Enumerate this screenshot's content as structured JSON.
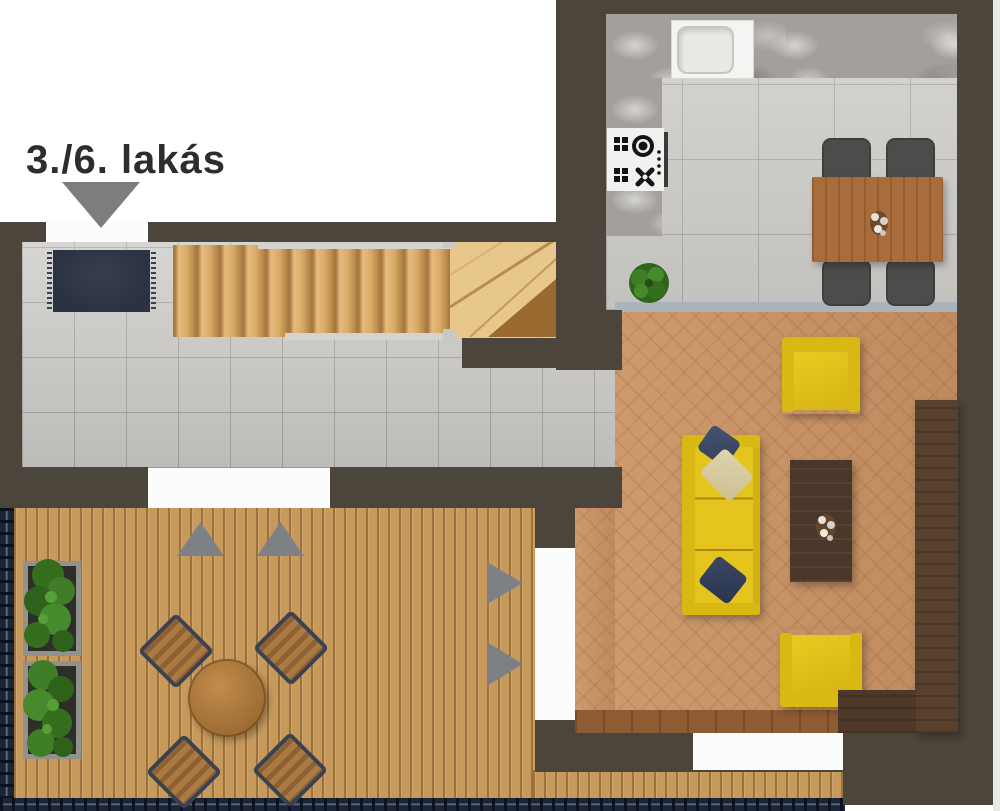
{
  "window": {
    "width": 1000,
    "height": 811
  },
  "plan": {
    "label": "3./6. lakás",
    "kind": "apartment floor plan, top-down render",
    "rooms": [
      {
        "id": "kitchen-dining",
        "furniture": [
          "L-shaped marble counter",
          "sink",
          "cooktop",
          "dining table",
          "4 dining chairs",
          "potted plant"
        ]
      },
      {
        "id": "living-room",
        "furniture": [
          "3-seat yellow sofa",
          "2 yellow armchairs",
          "dark coffee table",
          "media sideboard",
          "3 pillows"
        ]
      },
      {
        "id": "entry-hall",
        "furniture": [
          "doormat",
          "staircase with winder turn"
        ]
      },
      {
        "id": "terrace",
        "furniture": [
          "round wooden table",
          "4 deck chairs",
          "2 planters with greenery"
        ]
      }
    ],
    "stairs": {
      "straight_treads": 12
    },
    "markers": {
      "entrance_pointer": 1,
      "up_triangles": 2,
      "right_triangles": 2
    }
  },
  "palette": {
    "wall": "#4b453c",
    "hall_tile": "#cbcac7",
    "kitchen_tile": "#cdccc9",
    "living_floor": "#ca9364",
    "deck_wood": "#c79a5c",
    "stair_wood": "#d9ab67",
    "sofa_yellow": "#e5c51d",
    "dining_wood": "#a96c3b",
    "dark_furniture": "#4a372a",
    "railing_navy": "#1c2437",
    "marker_gray": "#7d7d7d",
    "door_white": "#fcfcfc",
    "doormat_navy": "#2b3242",
    "plant_green": "#3f7d27"
  }
}
